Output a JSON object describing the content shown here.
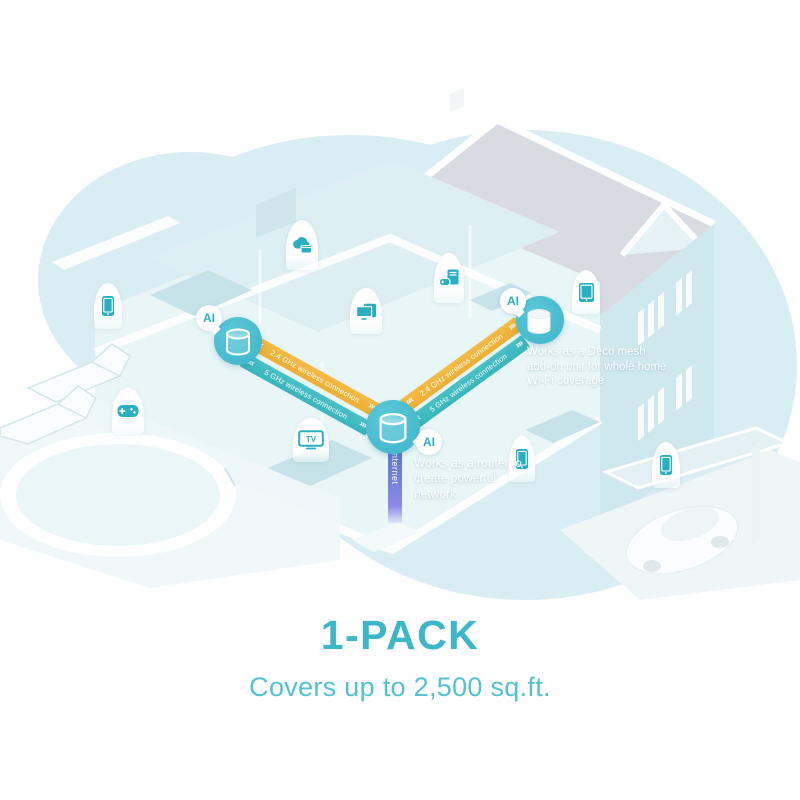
{
  "footer": {
    "pack_label": "1-PACK",
    "coverage_label": "Covers up to 2,500 sq.ft."
  },
  "nodes": {
    "router": {
      "ai_label": "AI",
      "caption": "Works as a router to create powerful network"
    },
    "extender": {
      "ai_label": "AI",
      "caption": "Works as a Deco mesh add-on unit for whole home Wi-Fi coverage"
    },
    "unit_left": {
      "ai_label": "AI"
    }
  },
  "links": {
    "left_24ghz": "2.4 GHz wireless connection",
    "left_5ghz": "5 GHz wireless connection",
    "right_24ghz": "2.4 GHz wireless connection",
    "right_5ghz": "5 GHz wireless connection"
  },
  "internet": {
    "label": "Internet"
  },
  "devices": {
    "tv_label": "TV"
  },
  "icons": {
    "chevrons_out_left": "‹‹‹",
    "chevrons_out_right": "›››",
    "device_icons": [
      "smartphone",
      "gamepad",
      "cloud-storage",
      "screen-mirroring",
      "desktop-gaming",
      "tv",
      "tablet",
      "smartphone",
      "smartphone"
    ]
  },
  "colors": {
    "band_24ghz": "#f0b43e",
    "band_5ghz": "#3fbcc2",
    "node_circle": "#49bdd0",
    "ai_text": "#2cb0c4",
    "internet_top": "#5577d2",
    "internet_bottom": "#9a92ec",
    "title_text": "#3db6c8",
    "subtitle_text": "#52c2d3",
    "device_icon": "#2aafc0",
    "house_blob": "#d9eef2",
    "roof": "#d9dbe2"
  }
}
